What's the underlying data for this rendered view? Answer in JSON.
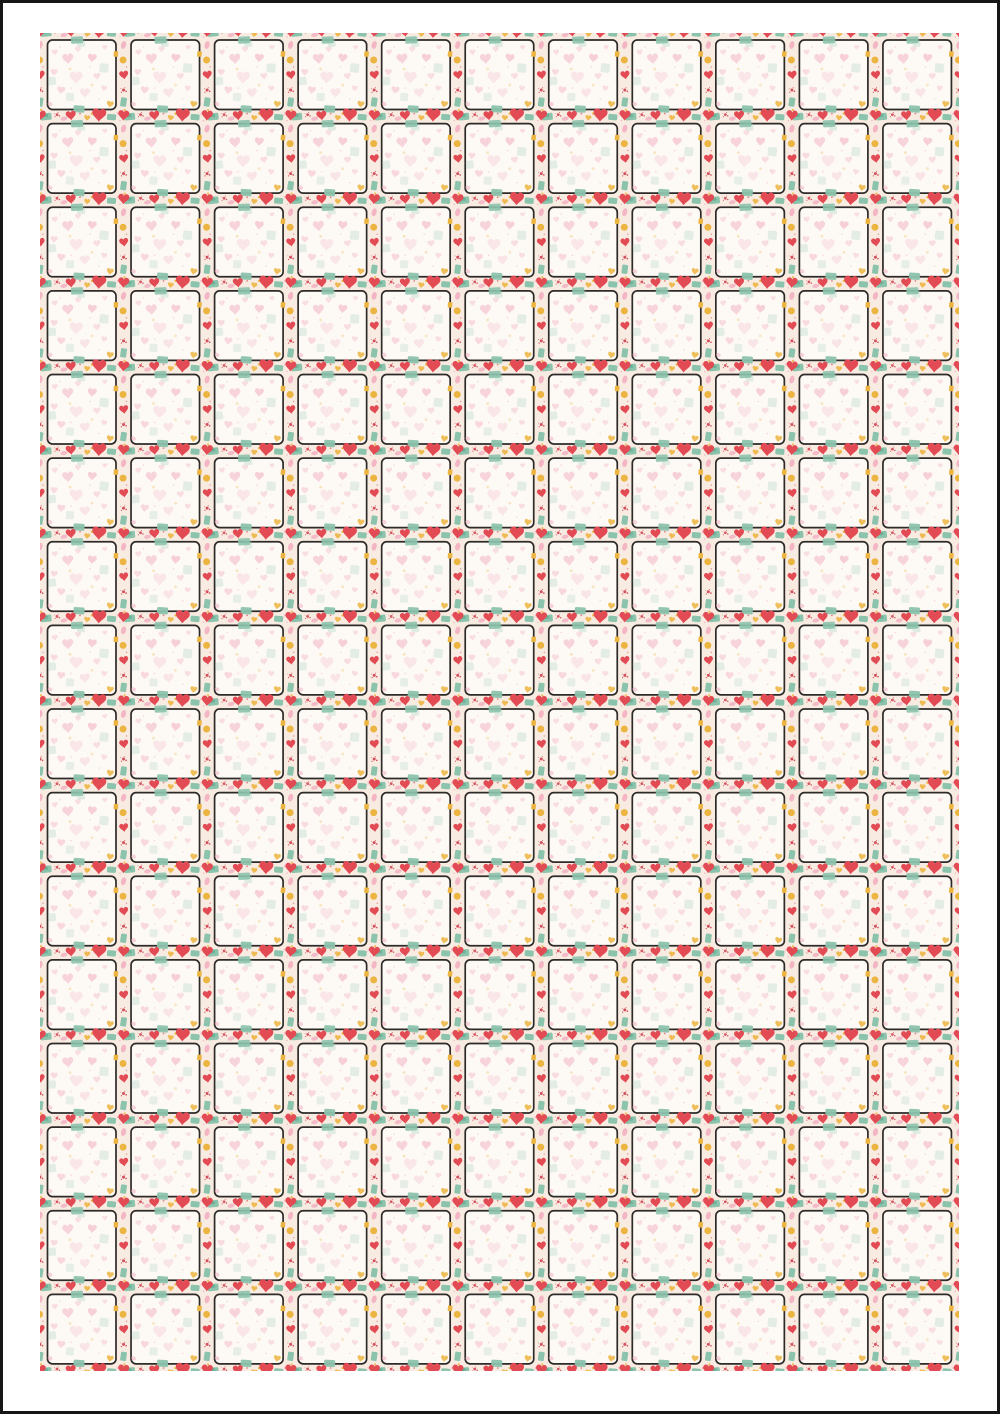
{
  "page": {
    "width": 1000,
    "height": 1414,
    "border_px": 3,
    "border_color": "#161616",
    "background": "#ffffff",
    "margins": {
      "left": 40,
      "top": 33,
      "right": 41,
      "bottom": 43
    }
  },
  "grid": {
    "rows": 16,
    "cols": 11,
    "tile_width": 83.545,
    "tile_height": 83.625
  },
  "colors": {
    "cream": "#f8ece2",
    "panel_bg": "#fdf9f5",
    "panel_border": "#2d2a28",
    "red": "#e24a54",
    "red_dark": "#cf3f4e",
    "pink": "#f2a9bd",
    "pink_heart": "#ee9cb4",
    "teal": "#8cc3ad",
    "teal_dark": "#5fa98e",
    "gold": "#ecb541"
  },
  "shapes": {
    "heart_path": "M 0 0.36 C -0.14 0.12 -0.5 -0.04 -0.5 -0.3 C -0.5 -0.47 -0.36 -0.57 -0.24 -0.57 C -0.11 -0.57 -0.03 -0.48 0 -0.39 C 0.03 -0.48 0.11 -0.57 0.24 -0.57 C 0.36 -0.57 0.5 -0.47 0.5 -0.3 C 0.5 -0.04 0.14 0.12 0 0.36 Z",
    "splat_offsets": [
      [
        0,
        0,
        1
      ],
      [
        1.7,
        0.9,
        0.55
      ],
      [
        -1.4,
        1.5,
        0.4
      ],
      [
        0.8,
        -1.5,
        0.35
      ],
      [
        -1.8,
        -0.9,
        0.28
      ]
    ]
  },
  "tile": {
    "panel": {
      "x": 7.5,
      "y": 7,
      "w": 68.5,
      "h": 69.5,
      "rx": 5,
      "fill": "panel_bg",
      "stroke": "panel_border",
      "sw": 1.7
    },
    "motifs_under": [
      {
        "t": "rect",
        "x": 6,
        "y": 0,
        "w": 11,
        "h": 7,
        "r": -5,
        "c": "teal"
      },
      {
        "t": "rect",
        "x": 6,
        "y": -1,
        "w": 4,
        "h": 3,
        "r": -5,
        "c": "teal_dark",
        "o": 0.7
      },
      {
        "t": "splat",
        "x": 17,
        "y": -2,
        "s": 1.4,
        "c": "red_dark",
        "o": 0.85
      },
      {
        "t": "smear",
        "x": 24,
        "y": 2,
        "w": 7,
        "h": 4,
        "r": -12,
        "c": "pink",
        "o": 0.75
      },
      {
        "t": "heart",
        "x": 31,
        "y": 0,
        "s": 10,
        "r": -6,
        "c": "red"
      },
      {
        "t": "dot",
        "x": 40,
        "y": -3,
        "s": 0.9,
        "c": "red_dark",
        "o": 0.6
      },
      {
        "t": "heart",
        "x": 47,
        "y": 2,
        "s": 6,
        "r": 8,
        "c": "gold",
        "o": 0.9
      },
      {
        "t": "dot",
        "x": 52,
        "y": -3,
        "s": 1.2,
        "c": "gold"
      },
      {
        "t": "heart",
        "x": 59,
        "y": 0,
        "s": 14,
        "r": 4,
        "c": "red"
      },
      {
        "t": "rect",
        "x": 71.5,
        "y": 0.5,
        "w": 9,
        "h": 6,
        "r": 4,
        "c": "teal"
      },
      {
        "t": "splat",
        "x": 78,
        "y": -3,
        "s": 1.1,
        "c": "pink",
        "o": 0.8
      },
      {
        "t": "heart",
        "x": 0,
        "y": 0,
        "s": 11,
        "r": 5,
        "c": "red"
      },
      {
        "t": "smear",
        "x": 0,
        "y": 12,
        "w": 5,
        "h": 8,
        "r": 15,
        "c": "pink",
        "o": 0.8
      },
      {
        "t": "dot",
        "x": -0.5,
        "y": 27,
        "s": 3.5,
        "c": "gold"
      },
      {
        "t": "heart",
        "x": 0.5,
        "y": 43,
        "s": 9,
        "r": -8,
        "c": "red"
      },
      {
        "t": "splat",
        "x": 0,
        "y": 57,
        "s": 1.5,
        "c": "red_dark",
        "o": 0.9
      },
      {
        "t": "rect",
        "x": 0,
        "y": 69,
        "w": 6,
        "h": 9,
        "r": 8,
        "c": "teal"
      },
      {
        "t": "dot",
        "x": 1,
        "y": 77,
        "s": 1.1,
        "c": "gold",
        "o": 0.9
      },
      {
        "t": "dot",
        "x": 3,
        "y": 34,
        "s": 0.7,
        "c": "red_dark",
        "o": 0.5
      },
      {
        "t": "dot",
        "x": 80,
        "y": 4,
        "s": 0.7,
        "c": "pink",
        "o": 0.8
      }
    ],
    "motifs_over": [
      {
        "t": "heart",
        "x": 28,
        "y": 27,
        "s": 11,
        "r": -5,
        "c": "pink_heart",
        "o": 0.4
      },
      {
        "t": "heart",
        "x": 52,
        "y": 26,
        "s": 9,
        "r": 6,
        "c": "pink_heart",
        "o": 0.45
      },
      {
        "t": "heart",
        "x": 38,
        "y": 17,
        "s": 6,
        "r": 0,
        "c": "pink_heart",
        "o": 0.3
      },
      {
        "t": "heart",
        "x": 15,
        "y": 20,
        "s": 6,
        "r": -8,
        "c": "pink_heart",
        "o": 0.3
      },
      {
        "t": "heart",
        "x": 14,
        "y": 40,
        "s": 7,
        "r": 5,
        "c": "pink_heart",
        "o": 0.32
      },
      {
        "t": "heart",
        "x": 36,
        "y": 46,
        "s": 13,
        "r": 3,
        "c": "pink_heart",
        "o": 0.2
      },
      {
        "t": "heart",
        "x": 57,
        "y": 44,
        "s": 7,
        "r": -6,
        "c": "pink_heart",
        "o": 0.3
      },
      {
        "t": "heart",
        "x": 21,
        "y": 58,
        "s": 8,
        "r": 7,
        "c": "pink_heart",
        "o": 0.35
      },
      {
        "t": "heart",
        "x": 45,
        "y": 61,
        "s": 10,
        "r": -4,
        "c": "pink_heart",
        "o": 0.22
      },
      {
        "t": "heart",
        "x": 64,
        "y": 56,
        "s": 6,
        "r": 8,
        "c": "pink_heart",
        "o": 0.3
      },
      {
        "t": "heart",
        "x": 65,
        "y": 15,
        "s": 5,
        "r": -5,
        "c": "pink_heart",
        "o": 0.28
      },
      {
        "t": "rect",
        "x": 41,
        "y": 10,
        "w": 8,
        "h": 8,
        "r": -4,
        "c": "teal",
        "o": 0.25
      },
      {
        "t": "rect",
        "x": 64,
        "y": 35,
        "w": 9,
        "h": 9,
        "r": 5,
        "c": "teal",
        "o": 0.22
      },
      {
        "t": "rect",
        "x": 12,
        "y": 48,
        "w": 8,
        "h": 8,
        "r": -6,
        "c": "teal",
        "o": 0.22
      },
      {
        "t": "rect",
        "x": 30,
        "y": 64,
        "w": 8,
        "h": 8,
        "r": 3,
        "c": "teal",
        "o": 0.2
      },
      {
        "t": "dot",
        "x": 30,
        "y": 36,
        "s": 1.4,
        "c": "gold",
        "o": 0.3
      },
      {
        "t": "dot",
        "x": 52,
        "y": 52,
        "s": 1.4,
        "c": "gold",
        "o": 0.28
      },
      {
        "t": "dot",
        "x": 20,
        "y": 14,
        "s": 0.8,
        "c": "pink",
        "o": 0.45
      },
      {
        "t": "dot",
        "x": 50,
        "y": 34,
        "s": 0.8,
        "c": "pink",
        "o": 0.45
      },
      {
        "t": "dot",
        "x": 31,
        "y": 55,
        "s": 0.8,
        "c": "pink",
        "o": 0.45
      },
      {
        "t": "dot",
        "x": 59,
        "y": 66,
        "s": 0.8,
        "c": "pink",
        "o": 0.45
      },
      {
        "t": "rect",
        "x": 37,
        "y": 7,
        "w": 12,
        "h": 7,
        "r": -3,
        "c": "teal",
        "o": 0.9
      },
      {
        "t": "rect",
        "x": 75.9,
        "y": 21,
        "w": 4.5,
        "h": 5.5,
        "r": 5,
        "c": "gold"
      },
      {
        "t": "rect",
        "x": 39,
        "y": 76,
        "w": 11,
        "h": 7,
        "r": 3,
        "c": "teal",
        "o": 0.95
      },
      {
        "t": "heart",
        "x": 70,
        "y": 72,
        "s": 7,
        "r": 10,
        "c": "gold",
        "o": 0.85
      },
      {
        "t": "smear",
        "x": 10,
        "y": 71,
        "w": 5,
        "h": 4,
        "r": 25,
        "c": "pink",
        "o": 0.5
      }
    ]
  }
}
